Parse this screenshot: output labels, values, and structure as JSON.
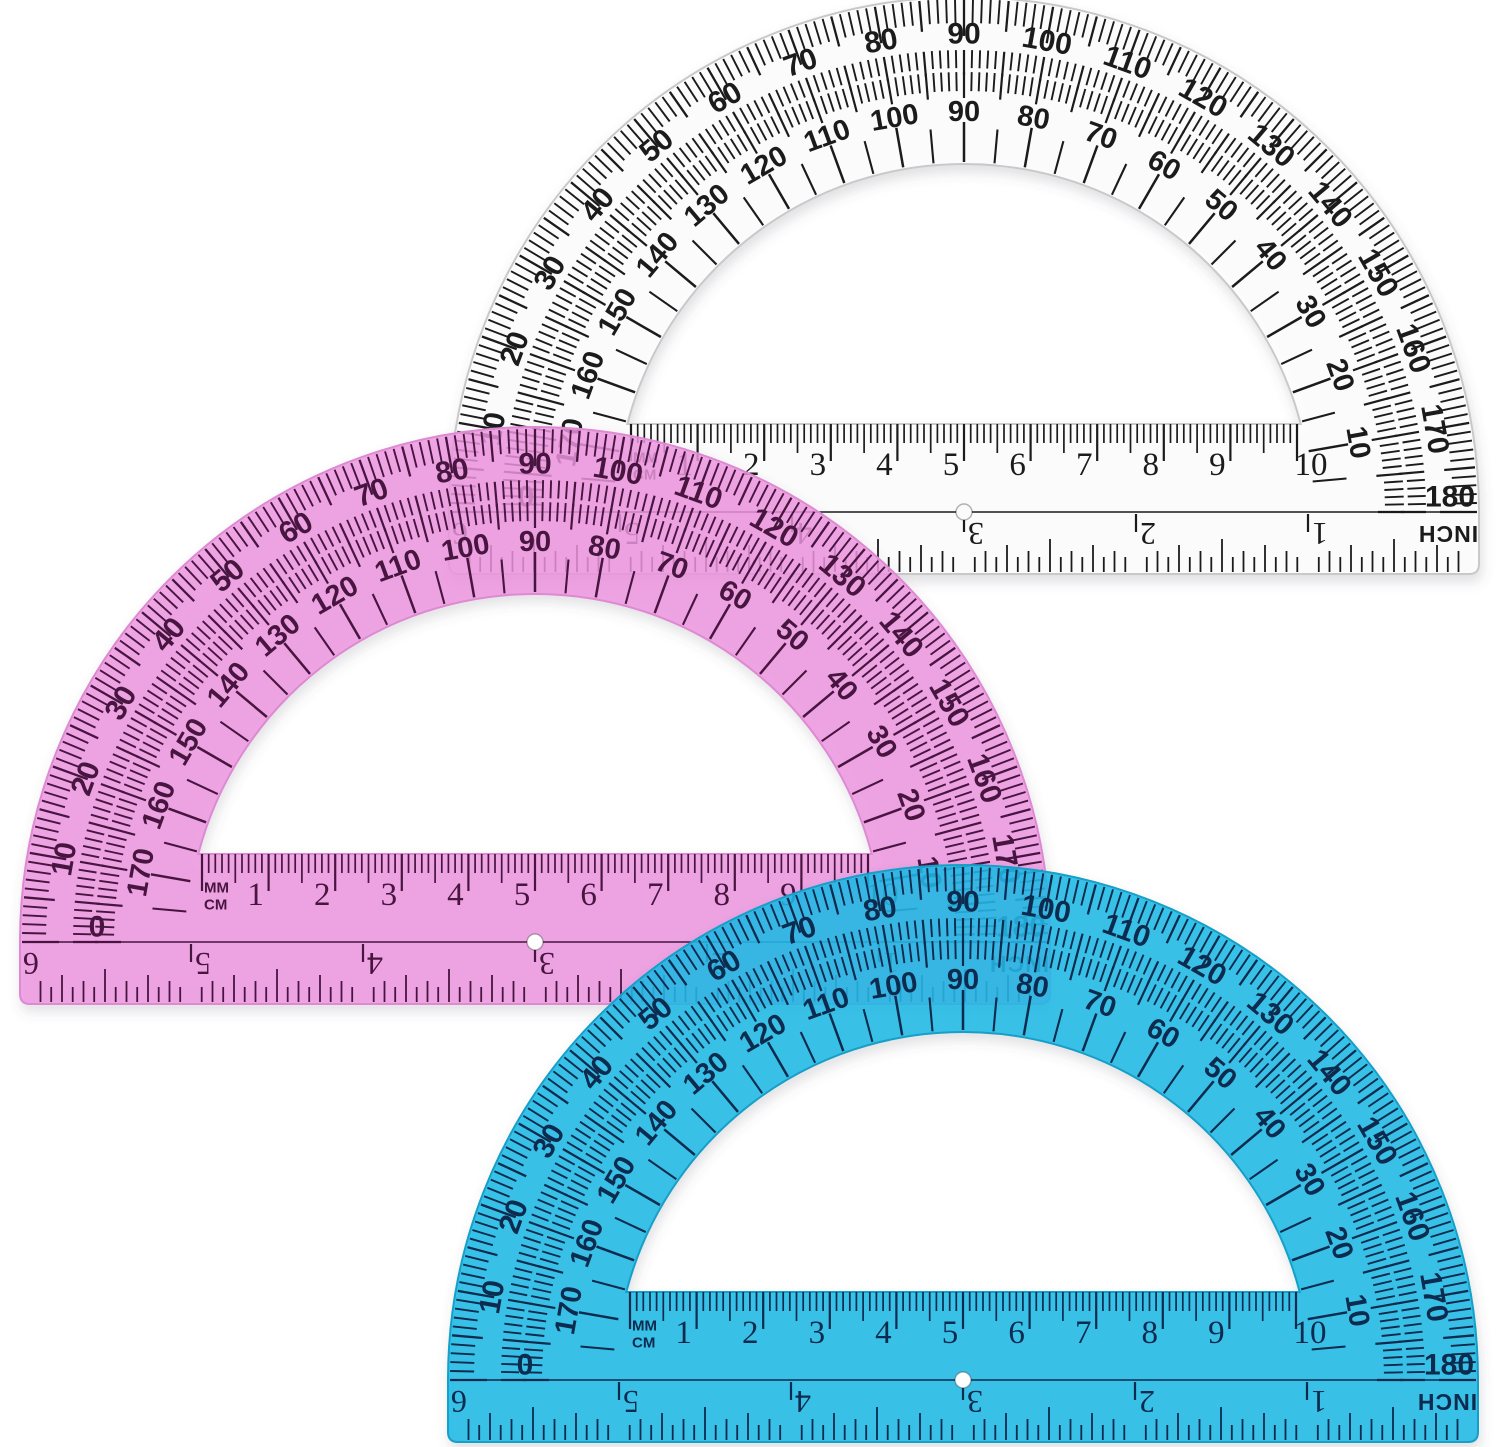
{
  "scene": {
    "background": "#ffffff",
    "description": "Three semicircular protractors with ruler base: clear (top), pink (middle left), blue (bottom)"
  },
  "scales": {
    "outer_degree_labels": [
      10,
      20,
      30,
      40,
      50,
      60,
      70,
      80,
      90,
      100,
      110,
      120,
      130,
      140,
      150,
      160,
      170
    ],
    "inner_degree_labels": [
      170,
      160,
      150,
      140,
      130,
      120,
      110,
      100,
      90,
      80,
      70,
      60,
      50,
      40,
      30,
      20,
      10
    ],
    "cm_labels": [
      1,
      2,
      3,
      4,
      5,
      6,
      7,
      8,
      9,
      10
    ],
    "inch_labels": [
      1,
      2,
      3,
      4,
      5,
      6
    ],
    "mm_unit_label": "MM",
    "cm_unit_label": "CM",
    "inch_unit_label": "INCH",
    "left_end_label": "0",
    "right_end_label": "180"
  },
  "protractors": [
    {
      "id": "clear",
      "cx": 964,
      "cy": 512,
      "body_color": "rgba(253,253,253,0.92)",
      "edge_color": "#c9c9c9",
      "ink_color": "#1b1b1b",
      "hole_fill": "#fafafa"
    },
    {
      "id": "pink",
      "cx": 535,
      "cy": 942,
      "body_color": "rgba(238,148,223,0.82)",
      "edge_color": "#dd8ad2",
      "ink_color": "#47153f",
      "hole_fill": "#ffffff"
    },
    {
      "id": "blue",
      "cx": 963,
      "cy": 1380,
      "body_color": "rgba(24,186,231,0.86)",
      "edge_color": "#149fc7",
      "ink_color": "#0c2b4e",
      "hole_fill": "#ffffff"
    }
  ]
}
